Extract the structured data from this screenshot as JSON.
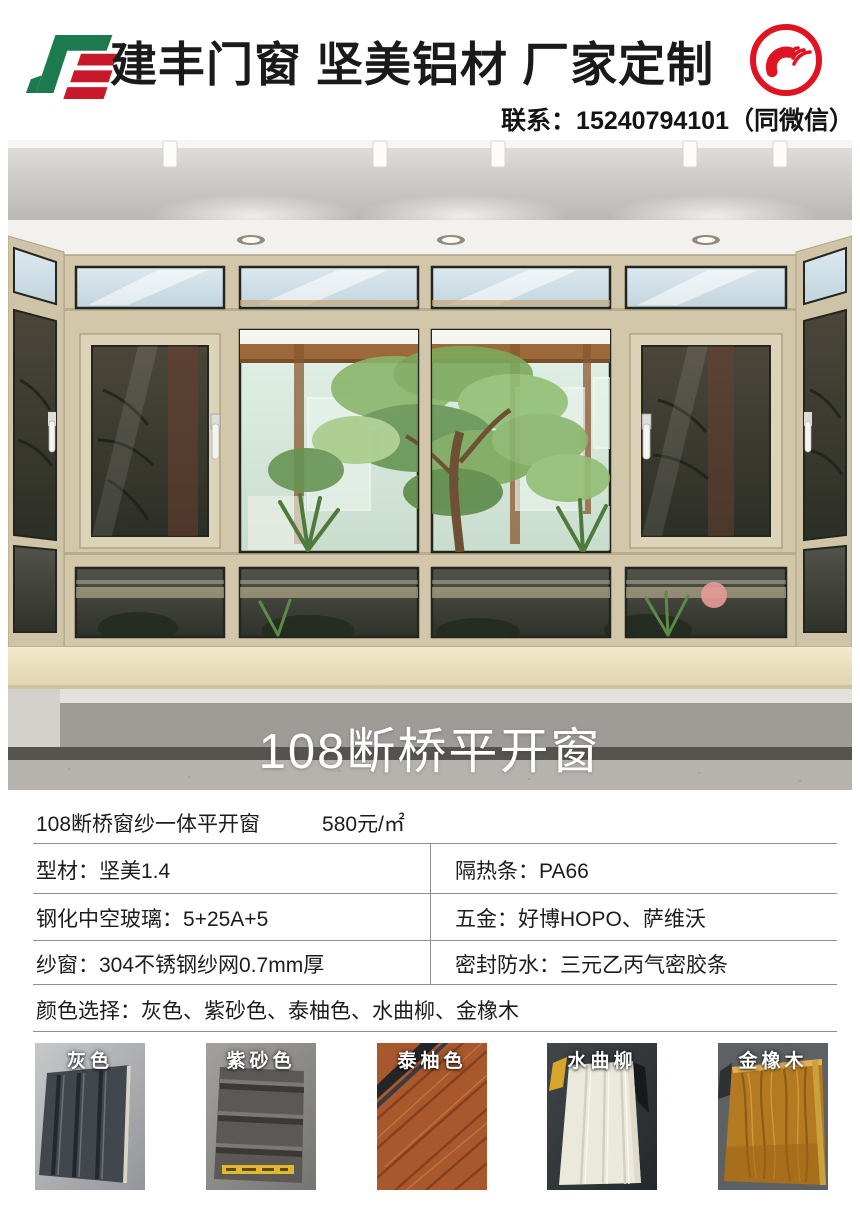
{
  "header": {
    "title": "建丰门窗 坚美铝材 厂家定制",
    "contact": "联系：15240794101（同微信）",
    "logo_icon": "jianfeng-logo-icon",
    "phone_icon": "phone-call-icon",
    "colors": {
      "accent_red": "#e01322",
      "logo_green": "#1d7a4e",
      "logo_red": "#c8192b"
    }
  },
  "hero": {
    "caption": "108断桥平开窗",
    "scene": "bay-window-showroom-photo",
    "frame_color": "#d2c7ab"
  },
  "specs": {
    "product_name": "108断桥窗纱一体平开窗",
    "price": "580元/㎡",
    "rows": [
      {
        "left": "型材：坚美1.4",
        "right": "隔热条：PA66"
      },
      {
        "left": "钢化中空玻璃：5+25A+5",
        "right": "五金：好博HOPO、萨维沃"
      },
      {
        "left": "纱窗：304不锈钢纱网0.7mm厚",
        "right": "密封防水：三元乙丙气密胶条"
      }
    ],
    "colors_row": "颜色选择：灰色、紫砂色、泰柚色、水曲柳、金橡木",
    "line_color": "#8f8f8f"
  },
  "swatches": [
    {
      "label": "灰色",
      "main_color": "#42464d"
    },
    {
      "label": "紫砂色",
      "main_color": "#5c5855"
    },
    {
      "label": "泰柚色",
      "main_color": "#a9572c"
    },
    {
      "label": "水曲柳",
      "main_color": "#ebe8dc"
    },
    {
      "label": "金橡木",
      "main_color": "#b47a22"
    }
  ]
}
